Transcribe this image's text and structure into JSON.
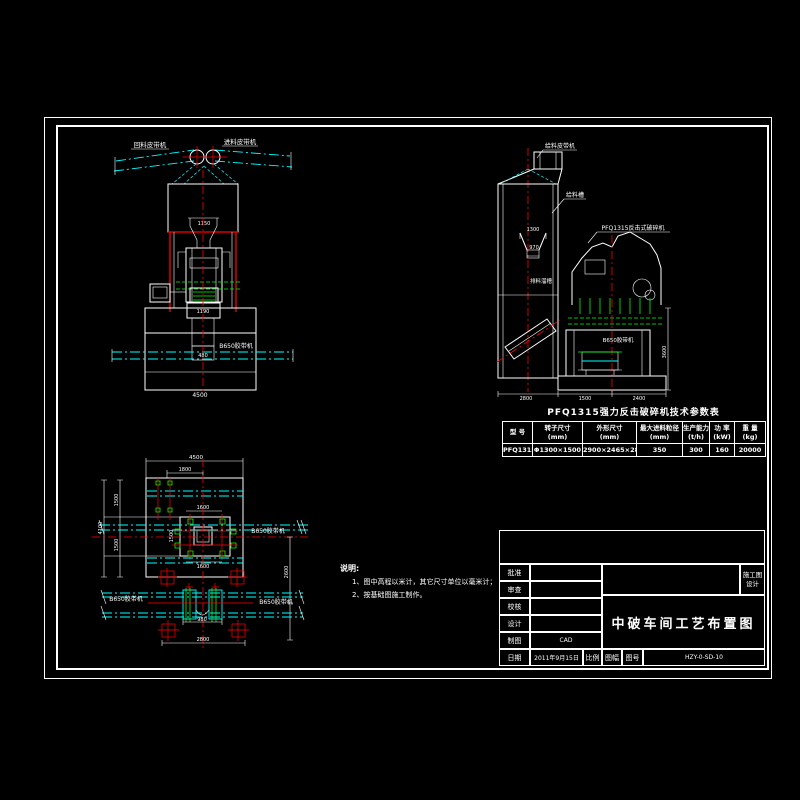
{
  "colors": {
    "background": "#000000",
    "line_white": "#ffffff",
    "line_cyan": "#00ffff",
    "line_red": "#ff0000",
    "line_green": "#00ff00"
  },
  "front_view": {
    "belt_label_left": "回料皮带机",
    "belt_label_right": "进料皮带机",
    "hopper_dim": "1150",
    "outlet_dim": "1190",
    "pit_dim": "480",
    "conveyor_label": "B650胶带机",
    "width_dim": "4500"
  },
  "side_view": {
    "feed_belt_label": "给料皮带机",
    "chute_label": "给料槽",
    "crusher_label": "PFQ1315反击式破碎机",
    "discharge_label": "排料溜槽",
    "conveyor_label": "B650胶带机",
    "dim_a": "1300",
    "dim_b": "970",
    "dim_right": "3600",
    "dim_bottom_left": "2800",
    "dim_bottom_mid": "1500",
    "dim_bottom_right": "2400"
  },
  "plan_view": {
    "dim_top": "4500",
    "dim_top_inner": "1800",
    "dim_left_upper": "1500",
    "dim_left_lower": "1500",
    "dim_left_total": "4100",
    "dim_inner_top": "1600",
    "dim_inner_left": "1500",
    "dim_inner_bottom": "1600",
    "dim_right": "2600",
    "conveyor_label_right": "B650胶带机",
    "conveyor_label_left": "B650胶带机",
    "conveyor_label_bottom": "B650胶带机",
    "dim_pulley": "980",
    "dim_bottom": "2800"
  },
  "notes": {
    "title": "说明:",
    "items": [
      "1、图中高程以米计，其它尺寸单位以毫米计；",
      "2、按基础图施工制作。"
    ]
  },
  "table": {
    "title": "PFQ1315强力反击破碎机技术参数表",
    "headers": [
      {
        "name": "型  号",
        "unit": ""
      },
      {
        "name": "转子尺寸",
        "unit": "(mm)"
      },
      {
        "name": "外形尺寸",
        "unit": "(mm)"
      },
      {
        "name": "最大进料粒径",
        "unit": "(mm)"
      },
      {
        "name": "生产能力",
        "unit": "(t/h)"
      },
      {
        "name": "功  率",
        "unit": "(kW)"
      },
      {
        "name": "重  量",
        "unit": "(kg)"
      }
    ],
    "row": [
      "PFQ1315",
      "Φ1300×1500",
      "2900×2465×2890",
      "350",
      "300",
      "160",
      "20000"
    ]
  },
  "title_block": {
    "rows": [
      {
        "label": "批准",
        "value": ""
      },
      {
        "label": "审查",
        "value": ""
      },
      {
        "label": "校核",
        "value": ""
      },
      {
        "label": "设计",
        "value": ""
      },
      {
        "label": "制图",
        "value": "CAD"
      }
    ],
    "date_label": "日期",
    "date_value": "2011年9月15日",
    "scale_label": "比例",
    "sheet_label": "图幅",
    "no_label": "图号",
    "no_value": "HZY-0-SD-10",
    "title": "中破车间工艺布置图",
    "stage_line1": "施工图",
    "stage_line2": "设计"
  }
}
